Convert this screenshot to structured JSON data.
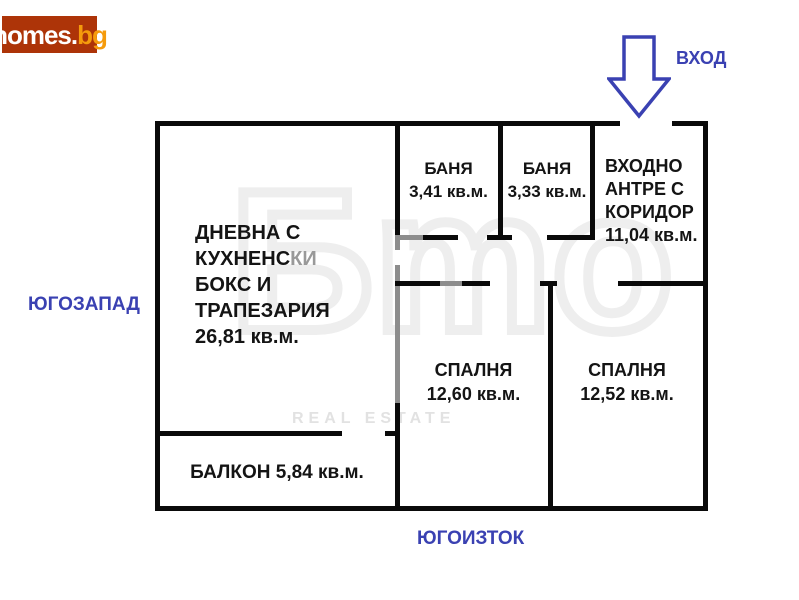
{
  "site": {
    "brand": "homes",
    "dot": ".",
    "tld": "bg"
  },
  "labels": {
    "entrance": "ВХОД",
    "southwest": "ЮГОЗАПАД",
    "southeast": "ЮГОИЗТОК"
  },
  "rooms": {
    "living": {
      "l1": "ДНЕВНА С",
      "l2a": "КУХНЕНС",
      "l2b": "КИ",
      "l3": "БОКС И",
      "l4": "ТРАПЕЗАРИЯ",
      "area": "26,81 кв.м."
    },
    "bath1": {
      "name": "БАНЯ",
      "area": "3,41 кв.м."
    },
    "bath2": {
      "name": "БАНЯ",
      "area": "3,33 кв.м."
    },
    "hall": {
      "l1": "ВХОДНО",
      "l2": "АНТРЕ С",
      "l3": "КОРИДОР",
      "area": "11,04 кв.м."
    },
    "bedroom1": {
      "name": "СПАЛНЯ",
      "area": "12,60 кв.м."
    },
    "bedroom2": {
      "name": "СПАЛНЯ",
      "area": "12,52 кв.м."
    },
    "balcony": {
      "label": "БАЛКОН 5,84 кв.м."
    }
  },
  "watermark": {
    "glyphs": "Бmo",
    "caption": "REAL ESTATE"
  },
  "colors": {
    "accent_blue": "#3a41b2",
    "logo_background": "#ad3408",
    "logo_tld": "#f59b0c",
    "wall": "#0a0a0a",
    "wall_faded": "#8d8d8d"
  }
}
